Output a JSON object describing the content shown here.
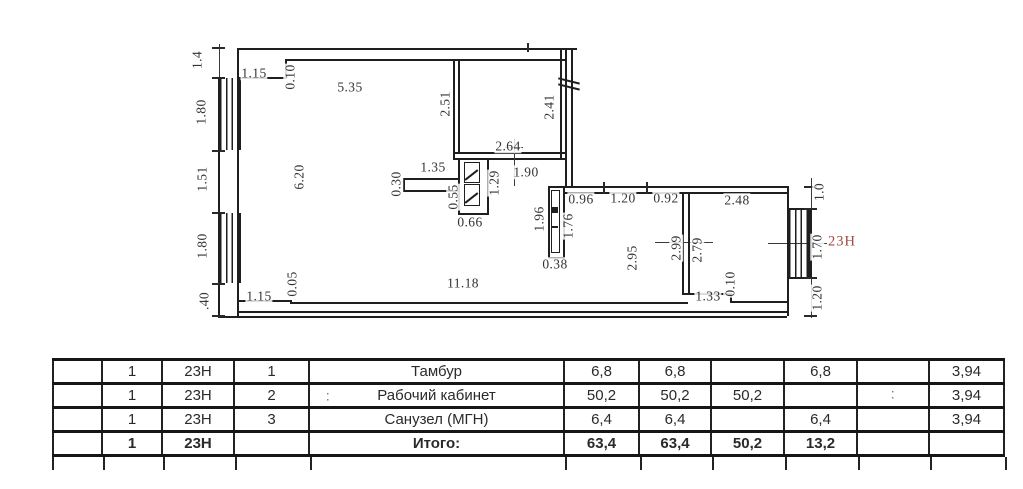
{
  "colors": {
    "ink": "#1f1f1f",
    "red_unit": "#a3483f"
  },
  "plan": {
    "unit_label": "23Н",
    "dimension_labels": [
      {
        "t": "1.4",
        "x": 197,
        "y": 60,
        "r": 90
      },
      {
        "t": "1.80",
        "x": 201,
        "y": 112,
        "r": 90
      },
      {
        "t": "1.51",
        "x": 202,
        "y": 179,
        "r": 90
      },
      {
        "t": "1.80",
        "x": 202,
        "y": 246,
        "r": 90
      },
      {
        "t": ".40",
        "x": 204,
        "y": 301,
        "r": 90
      },
      {
        "t": "1.15",
        "x": 254,
        "y": 73,
        "r": 0
      },
      {
        "t": "0.10",
        "x": 290,
        "y": 77,
        "r": 90
      },
      {
        "t": "5.35",
        "x": 350,
        "y": 87,
        "r": 0
      },
      {
        "t": "6.20",
        "x": 299,
        "y": 177,
        "r": 90
      },
      {
        "t": "2.51",
        "x": 445,
        "y": 104,
        "r": 90
      },
      {
        "t": "2.41",
        "x": 549,
        "y": 107,
        "r": 90
      },
      {
        "t": "2.64",
        "x": 508,
        "y": 146,
        "r": 0
      },
      {
        "t": "1.90",
        "x": 526,
        "y": 172,
        "r": 0
      },
      {
        "t": "1.35",
        "x": 433,
        "y": 167,
        "r": 0
      },
      {
        "t": "0.30",
        "x": 396,
        "y": 184,
        "r": 90
      },
      {
        "t": "1.29",
        "x": 494,
        "y": 183,
        "r": 90
      },
      {
        "t": "0.55",
        "x": 453,
        "y": 197,
        "r": 90
      },
      {
        "t": "0.66",
        "x": 470,
        "y": 222,
        "r": 0
      },
      {
        "t": "1.96",
        "x": 539,
        "y": 219,
        "r": 90
      },
      {
        "t": "1.76",
        "x": 568,
        "y": 226,
        "r": 90
      },
      {
        "t": "0.38",
        "x": 555,
        "y": 264,
        "r": 0
      },
      {
        "t": "0.96",
        "x": 581,
        "y": 199,
        "r": 0
      },
      {
        "t": "1.20",
        "x": 623,
        "y": 198,
        "r": 0
      },
      {
        "t": "0.92",
        "x": 666,
        "y": 198,
        "r": 0
      },
      {
        "t": "2.48",
        "x": 737,
        "y": 200,
        "r": 0
      },
      {
        "t": "2.95",
        "x": 632,
        "y": 258,
        "r": 90
      },
      {
        "t": "2.99",
        "x": 676,
        "y": 248,
        "r": 90
      },
      {
        "t": "2.79",
        "x": 697,
        "y": 250,
        "r": 90
      },
      {
        "t": "0.10",
        "x": 730,
        "y": 284,
        "r": 90
      },
      {
        "t": "1.33",
        "x": 708,
        "y": 296,
        "r": 0
      },
      {
        "t": "11.18",
        "x": 463,
        "y": 283,
        "r": 0
      },
      {
        "t": "1.15",
        "x": 259,
        "y": 296,
        "r": 0
      },
      {
        "t": "0.05",
        "x": 292,
        "y": 284,
        "r": 90
      },
      {
        "t": "1.0",
        "x": 819,
        "y": 192,
        "r": 90
      },
      {
        "t": "1.70",
        "x": 817,
        "y": 247,
        "r": 90
      },
      {
        "t": "1.20",
        "x": 817,
        "y": 298,
        "r": 90
      },
      {
        "t": ":",
        "x": 328,
        "y": 396,
        "r": 0,
        "f": 1
      },
      {
        "t": ":",
        "x": 893,
        "y": 394,
        "r": 0,
        "f": 1
      }
    ]
  },
  "table": {
    "rows": [
      {
        "bold": false,
        "cells": [
          "",
          "1",
          "23Н",
          "1",
          "Тамбур",
          "6,8",
          "6,8",
          "",
          "6,8",
          "",
          "3,94"
        ]
      },
      {
        "bold": false,
        "cells": [
          "",
          "1",
          "23Н",
          "2",
          "Рабочий кабинет",
          "50,2",
          "50,2",
          "50,2",
          "",
          "",
          "3,94"
        ]
      },
      {
        "bold": false,
        "cells": [
          "",
          "1",
          "23Н",
          "3",
          "Санузел (МГН)",
          "6,4",
          "6,4",
          "",
          "6,4",
          "",
          "3,94"
        ]
      },
      {
        "bold": true,
        "cells": [
          "",
          "1",
          "23Н",
          "",
          "Итого:",
          "63,4",
          "63,4",
          "50,2",
          "13,2",
          "",
          ""
        ]
      }
    ]
  }
}
